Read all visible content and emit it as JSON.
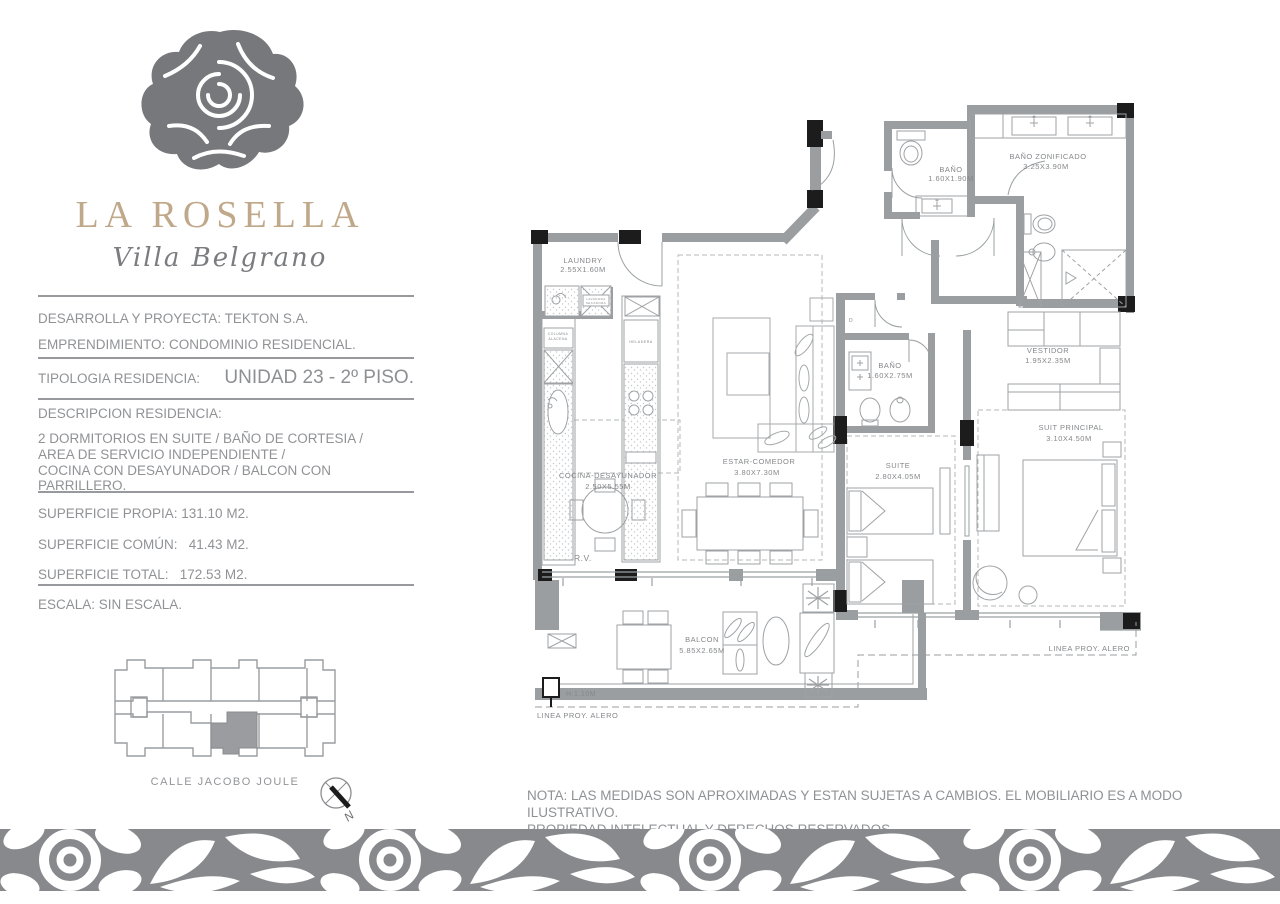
{
  "brand": {
    "name": "LA ROSELLA",
    "subtitle": "Villa Belgrano"
  },
  "info": {
    "developer": "DESARROLLA Y PROYECTA: TEKTON S.A.",
    "project": "EMPRENDIMIENTO: CONDOMINIO RESIDENCIAL.",
    "typology_label": "TIPOLOGIA RESIDENCIA:",
    "typology_value": "UNIDAD 23 - 2º PISO.",
    "description_label": "DESCRIPCION RESIDENCIA:",
    "description_lines": [
      "2 DORMITORIOS EN SUITE / BAÑO DE CORTESIA /",
      "AREA DE SERVICIO INDEPENDIENTE /",
      "COCINA CON DESAYUNADOR / BALCON CON PARRILLERO."
    ],
    "surface_own": "SUPERFICIE PROPIA: 131.10 M2.",
    "surface_common": "SUPERFICIE COMÚN:   41.43 M2.",
    "surface_total": "SUPERFICIE TOTAL:   172.53 M2.",
    "scale": "ESCALA: SIN ESCALA."
  },
  "site_plan": {
    "street": "CALLE JACOBO JOULE",
    "compass": "N"
  },
  "floor_plan": {
    "rooms": {
      "laundry": {
        "name": "LAUNDRY",
        "dims": "2.55X1.60M"
      },
      "bano_cortesia": {
        "name": "BAÑO",
        "dims": "1.60X1.90M"
      },
      "bano_zonificado": {
        "name": "BAÑO ZONIFICADO",
        "dims": "3.25X3.90M"
      },
      "vestidor": {
        "name": "VESTIDOR",
        "dims": "1.95X2.35M"
      },
      "bano_suite": {
        "name": "BAÑO",
        "dims": "1.60X2.75M"
      },
      "suite": {
        "name": "SUITE",
        "dims": "2.80X4.05M"
      },
      "suite_principal": {
        "name": "SUIT PRINCIPAL",
        "dims": "3.10X4.50M"
      },
      "estar": {
        "name": "ESTAR-COMEDOR",
        "dims": "3.80X7.30M"
      },
      "cocina": {
        "name": "COCINA-DESAYUNADOR",
        "dims": "2.50X5.55M"
      },
      "balcon": {
        "name": "BALCON",
        "dims": "5.85X2.65M"
      }
    },
    "annotations": {
      "rv": "R.V.",
      "height": "H:1.10M",
      "alero_left": "LINEA PROY. ALERO",
      "alero_right": "LINEA PROY. ALERO",
      "door_tag": "D"
    },
    "appliances": {
      "lavadora_1": "LAVADORA",
      "lavadora_2": "SECADORA",
      "columna_1": "COLUMNA",
      "columna_2": "ALACENA",
      "heladera": "HELADERA"
    }
  },
  "note": {
    "line1": "NOTA: LAS MEDIDAS SON APROXIMADAS Y ESTAN SUJETAS A CAMBIOS. EL MOBILIARIO ES A MODO ILUSTRATIVO.",
    "line2": "PROPIEDAD INTELECTUAL Y DERECHOS RESERVADOS."
  },
  "colors": {
    "brand_gold": "#c0a98a",
    "logo_gray": "#77787b",
    "text_gray": "#909295",
    "wall_gray": "#9b9ea1",
    "band_gray": "#87898c",
    "black": "#1c1c1c"
  }
}
